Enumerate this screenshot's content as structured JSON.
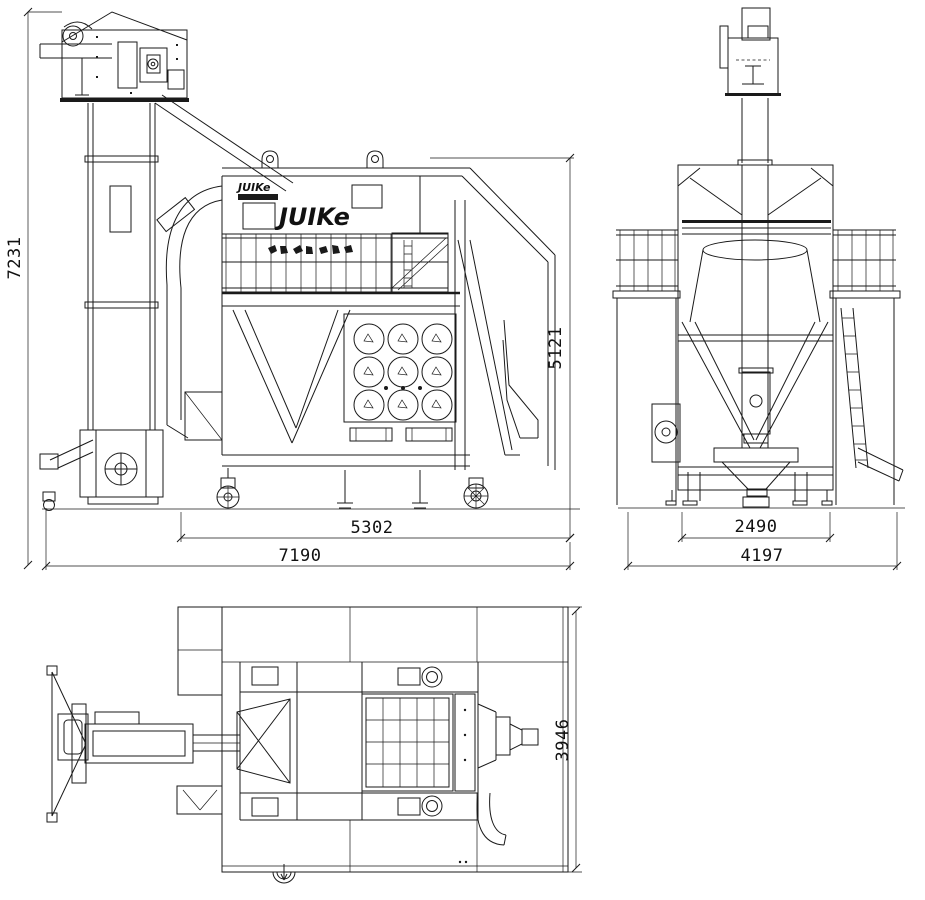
{
  "colors": {
    "line": "#1a1a1a",
    "background": "#ffffff"
  },
  "brand": {
    "logo_small": "JUIKe",
    "logo_large": "JUIKe"
  },
  "dims": {
    "front_total_height": "7231",
    "front_body_height": "5121",
    "front_body_width": "5302",
    "front_total_width": "7190",
    "side_body_width": "2490",
    "side_total_width": "4197",
    "plan_depth": "3946"
  }
}
